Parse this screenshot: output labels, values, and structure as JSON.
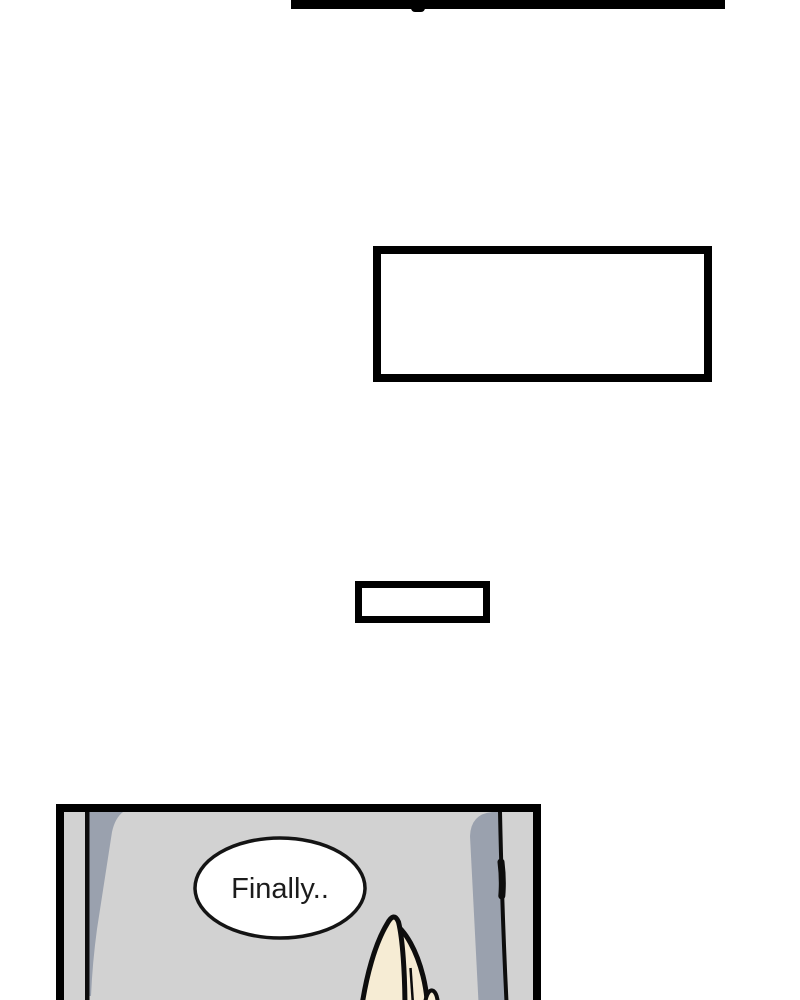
{
  "canvas": {
    "width": 800,
    "height": 1000,
    "background": "#ffffff"
  },
  "previous_panel_edge": {
    "color": "#000000"
  },
  "empty_panel_large": {
    "fill": "#ffffff",
    "border_color": "#000000"
  },
  "empty_panel_small": {
    "fill": "#ffffff",
    "border_color": "#000000"
  },
  "bottom_panel": {
    "background": "#d2d2d2",
    "border_color": "#000000",
    "wall_shadow_color": "#9aa1ae",
    "ink_color": "#0d0d0d",
    "speech_bubble": {
      "text": "Finally..",
      "fill": "#ffffff",
      "outline": "#141414",
      "text_color": "#1c1c1c"
    },
    "hand": {
      "skin_color": "#f6ecd4",
      "outline_color": "#0d0d0d"
    }
  }
}
